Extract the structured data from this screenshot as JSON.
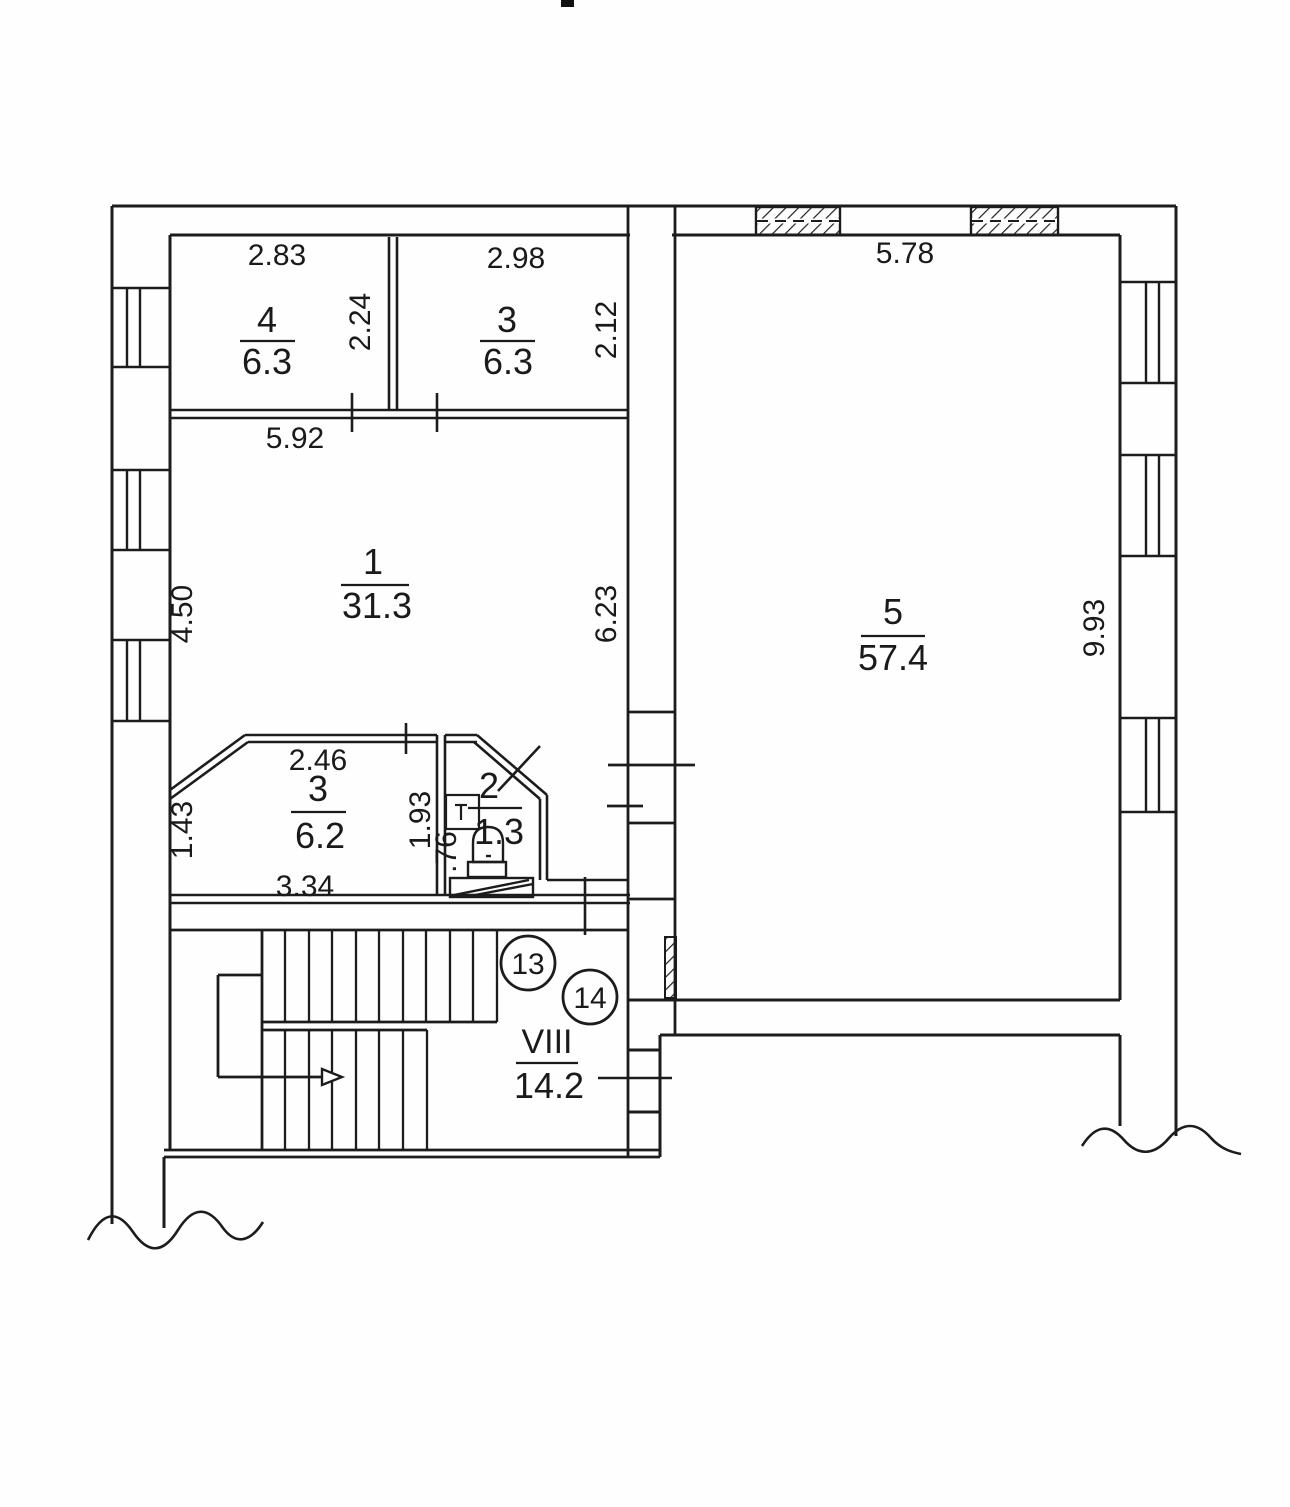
{
  "rooms": {
    "r4": {
      "number": "4",
      "area": "6.3"
    },
    "r3t": {
      "number": "3",
      "area": "6.3"
    },
    "r1": {
      "number": "1",
      "area": "31.3"
    },
    "r5": {
      "number": "5",
      "area": "57.4"
    },
    "r3b": {
      "number": "3",
      "area": "6.2"
    },
    "wc": {
      "number": "2",
      "area": "1.3"
    },
    "stair": {
      "number": "VIII",
      "area": "14.2"
    }
  },
  "dims": {
    "r4_w": "2.83",
    "r4_h": "2.24",
    "r3t_w": "2.98",
    "r3t_h": "2.12",
    "r1_w": "5.92",
    "r1_h_left": "4.50",
    "r1_h_right": "6.23",
    "r5_w": "5.78",
    "r5_h": "9.93",
    "r3b_top": "2.46",
    "r3b_h": "1.43",
    "r3b_w": "3.34",
    "wc_h": "1.93",
    "wc_w": ".76"
  },
  "markers": {
    "n13": "13",
    "n14": "14"
  }
}
